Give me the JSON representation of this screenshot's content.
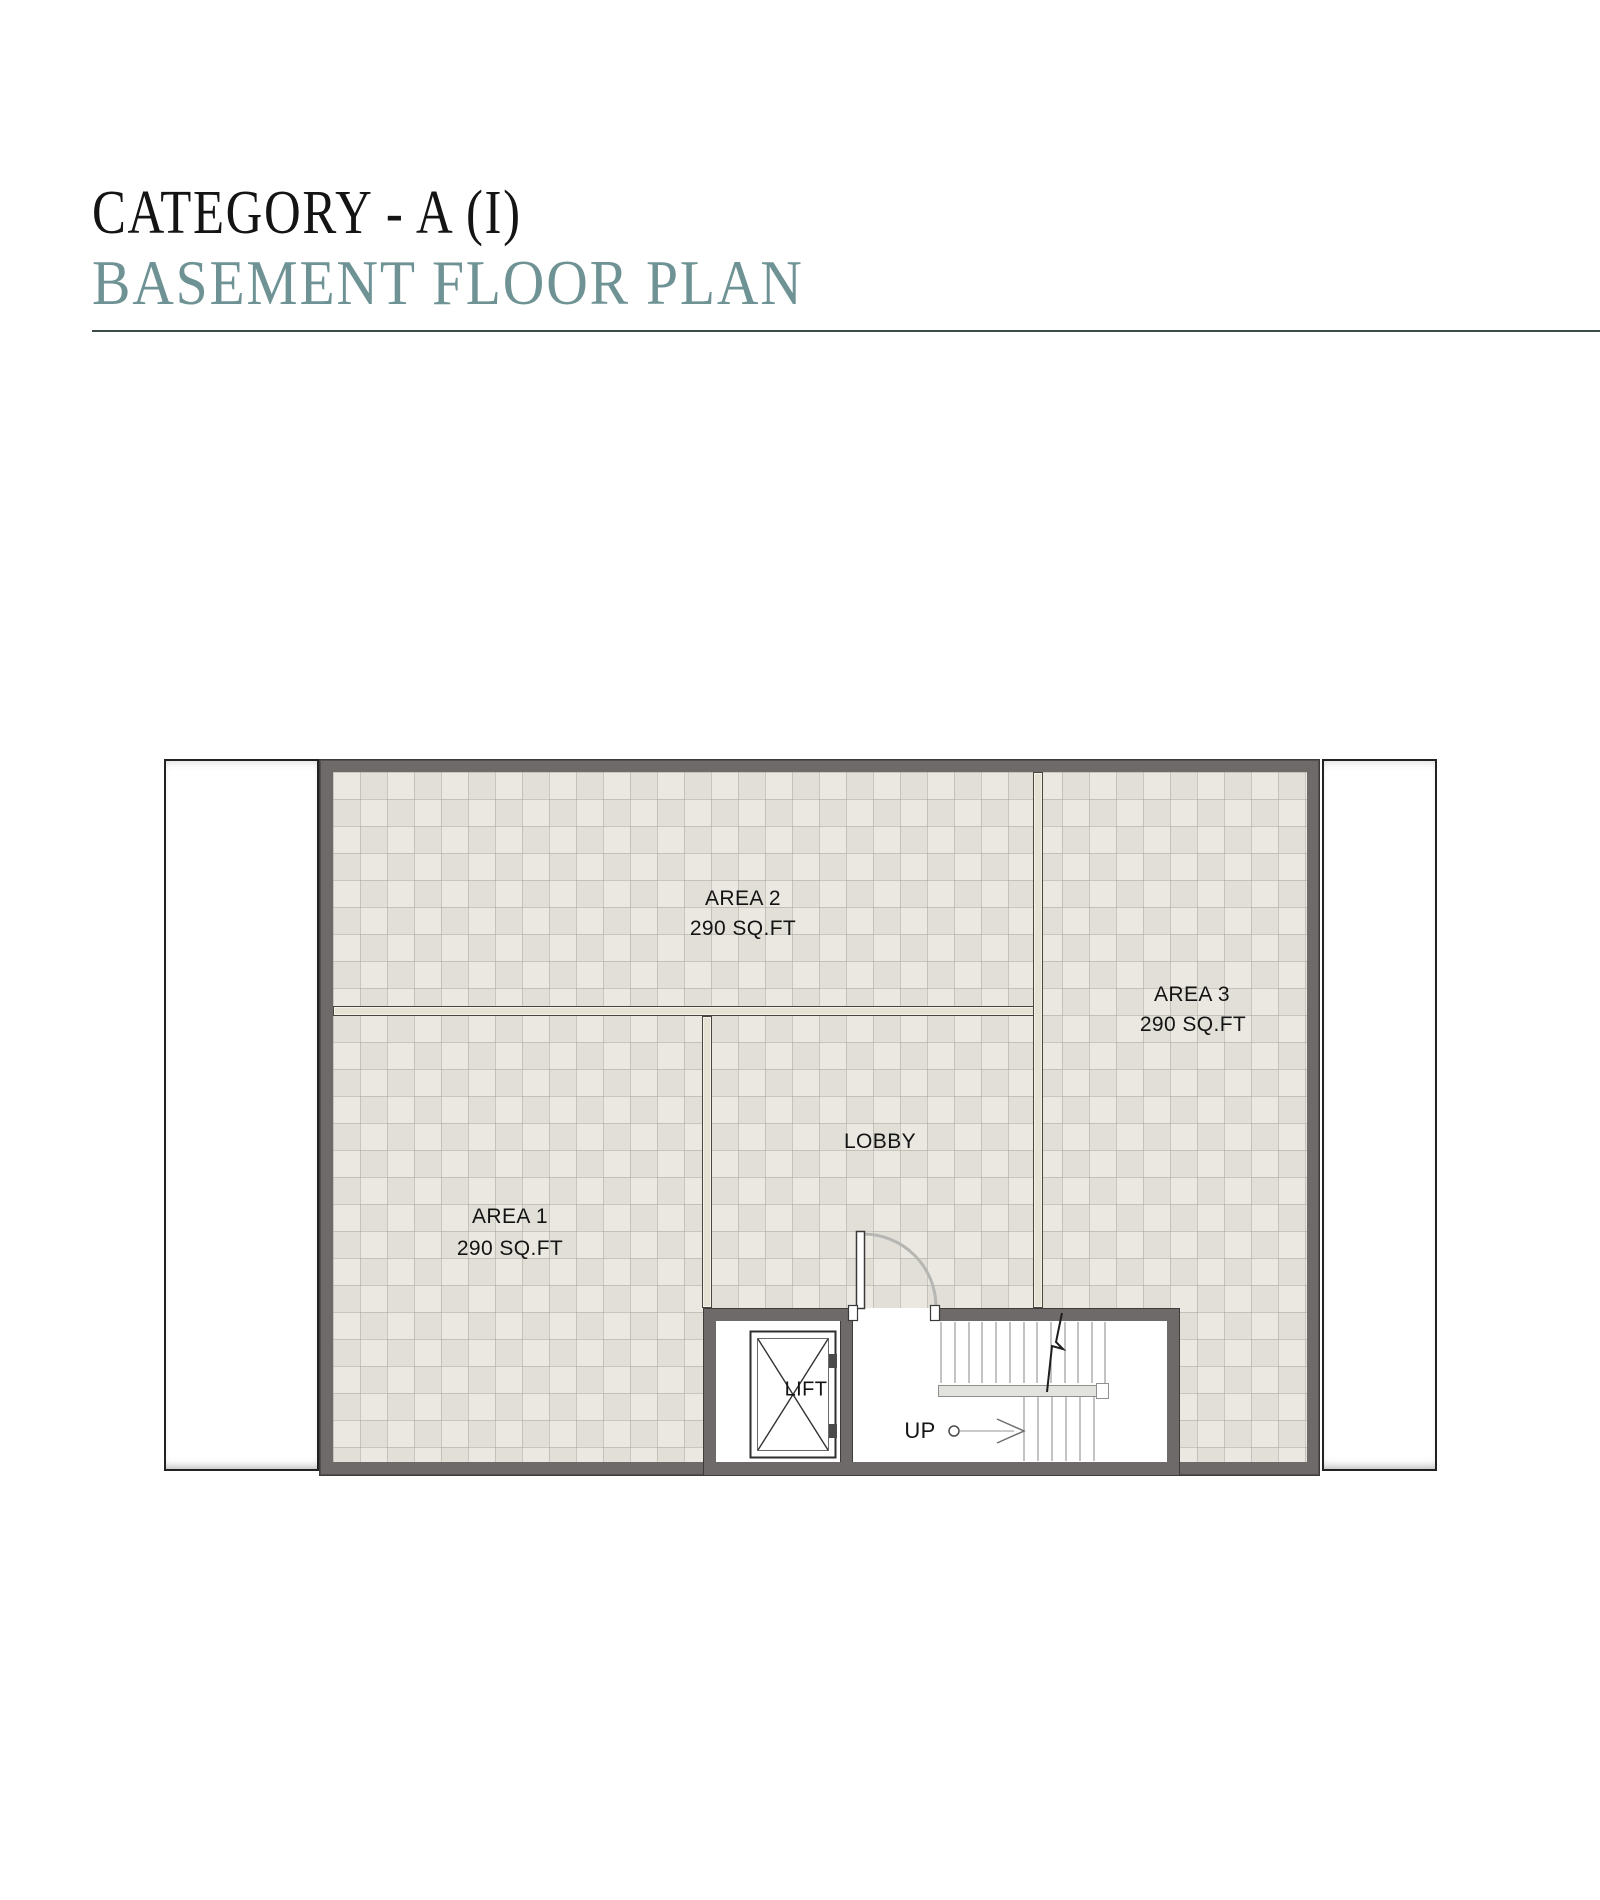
{
  "header": {
    "title": "CATEGORY - A (I)",
    "subtitle": "BASEMENT FLOOR PLAN"
  },
  "plan": {
    "rooms": [
      {
        "name": "AREA 2",
        "area": "290 SQ.FT"
      },
      {
        "name": "AREA 3",
        "area": "290 SQ.FT"
      },
      {
        "name": "AREA 1",
        "area": "290 SQ.FT"
      },
      {
        "name": "LOBBY"
      }
    ],
    "lift_label": "LIFT",
    "up_label": "UP"
  },
  "colors": {
    "title_text": "#141414",
    "subtitle_text": "#6f9394",
    "rule_line": "#3c4b47",
    "wall_dark": "#6e6a69",
    "wall_cream": "#e6e2d3",
    "tile_floor": "#eae8e1",
    "label_text": "#141414"
  }
}
